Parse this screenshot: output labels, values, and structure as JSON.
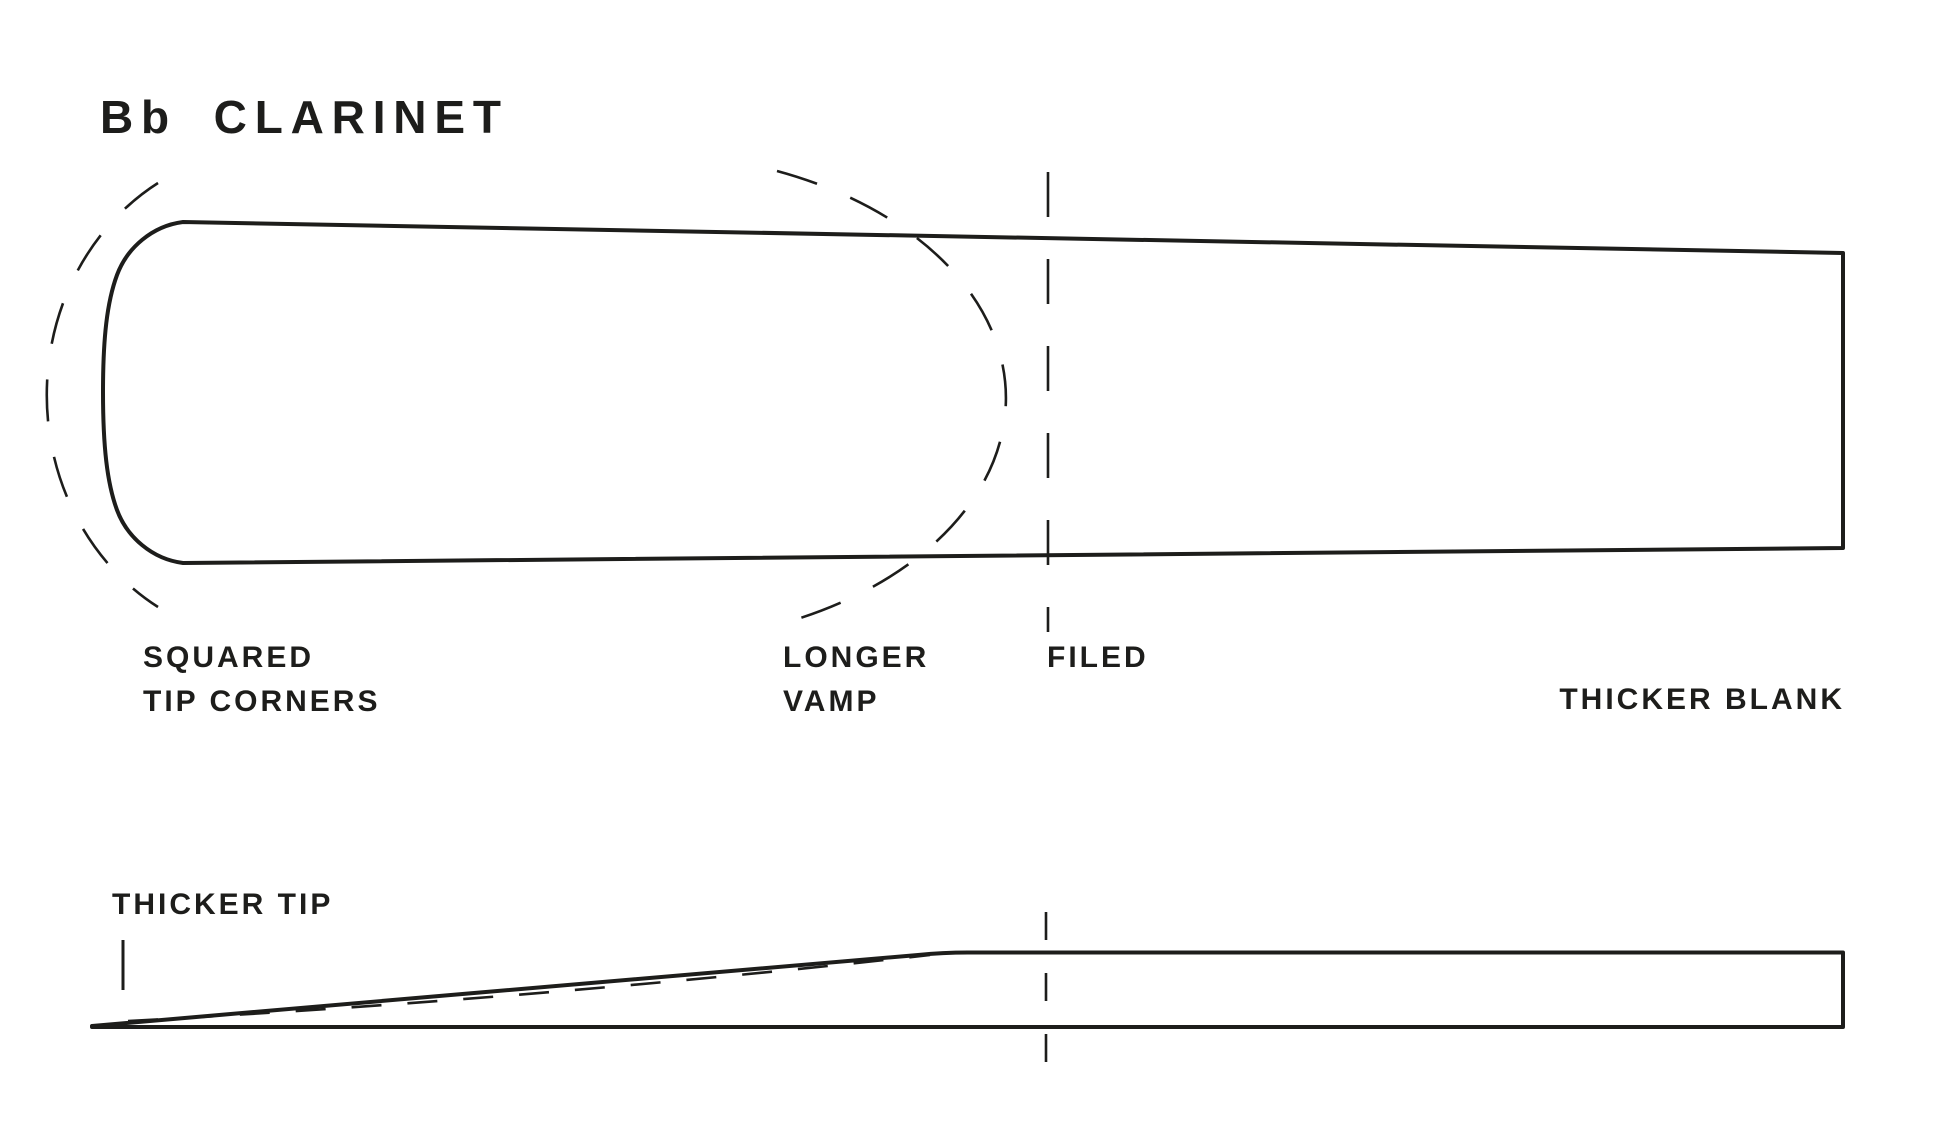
{
  "title": "Bb CLARINET",
  "colors": {
    "ink": "#1d1d1b",
    "paper": "#ffffff"
  },
  "figure": {
    "front_view": {
      "annotations": {
        "squared_tip_corners": "SQUARED\nTIP CORNERS",
        "longer_vamp": "LONGER\nVAMP",
        "filed": "FILED",
        "thicker_blank": "THICKER BLANK"
      }
    },
    "side_view": {
      "annotations": {
        "thicker_tip": "THICKER TIP"
      }
    }
  }
}
